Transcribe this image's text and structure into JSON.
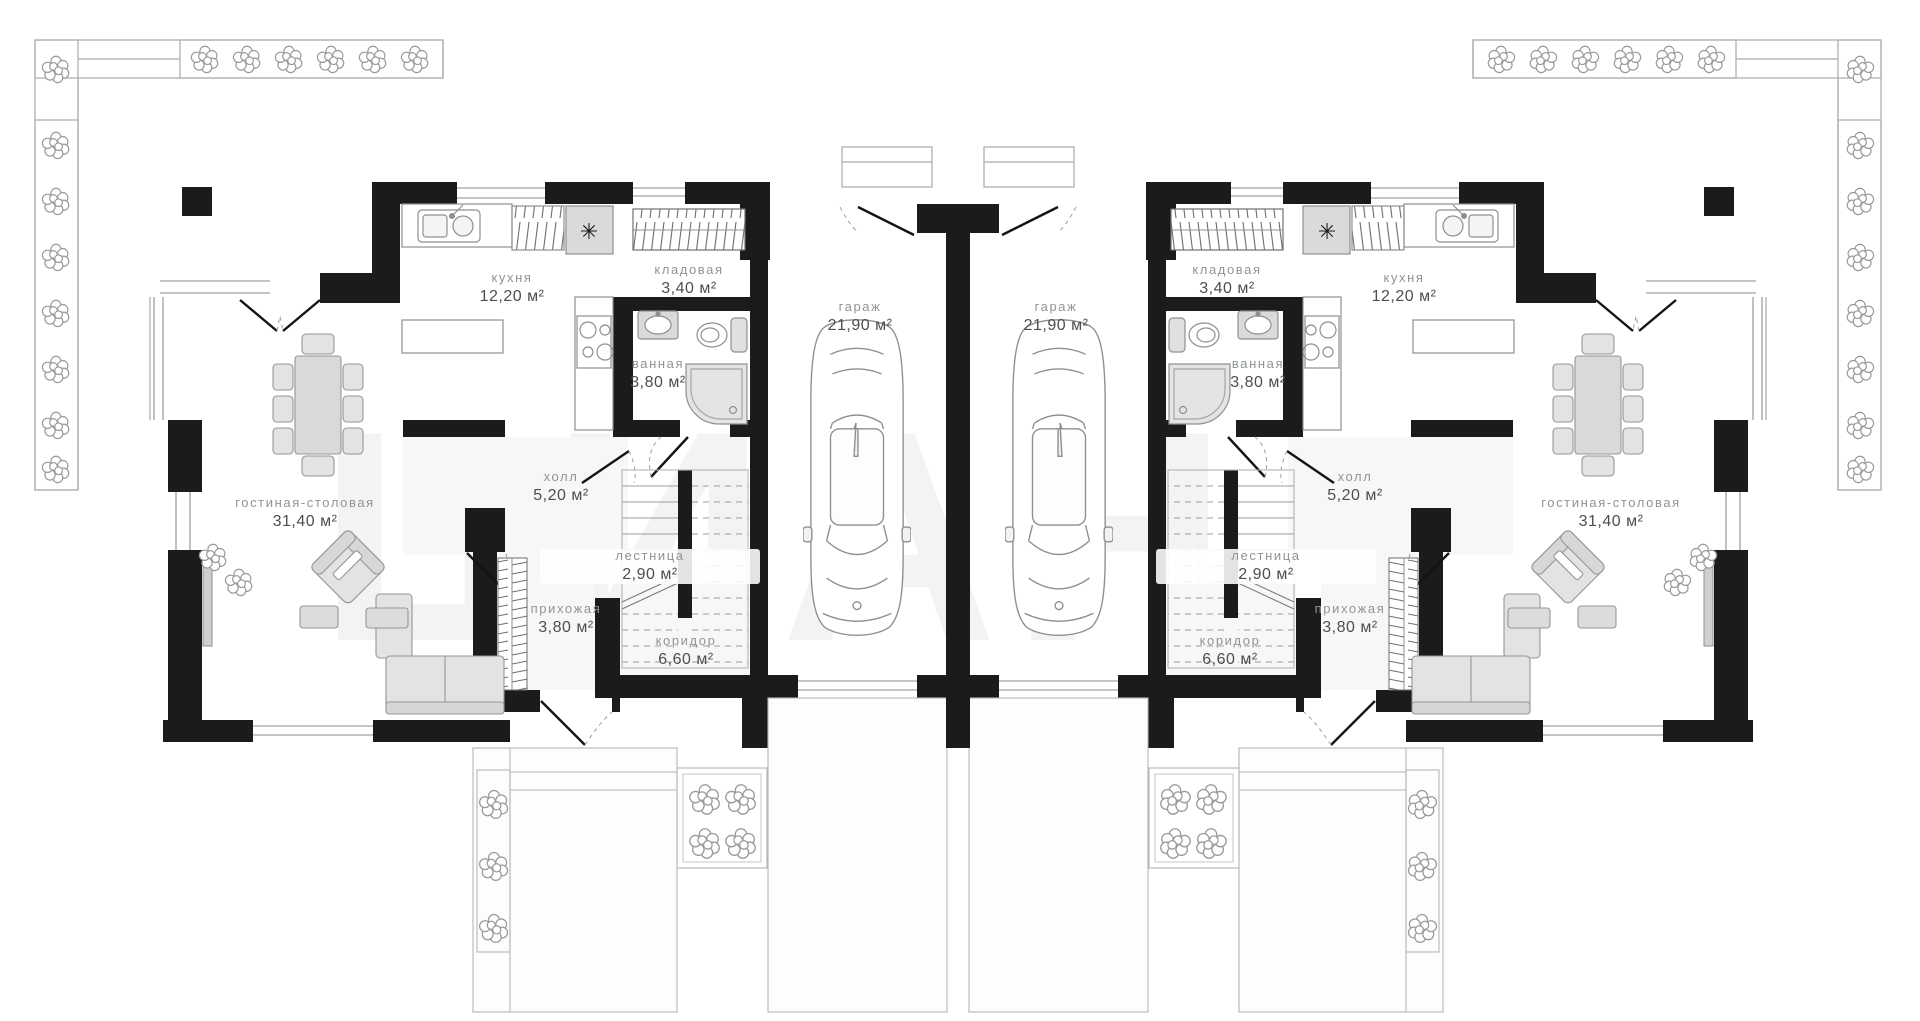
{
  "watermark": "ЦИАН",
  "icons": {
    "fridge": "✳"
  },
  "colors": {
    "wall": "#1b1b1b",
    "outline": "#a5a5a5",
    "furniture_stroke": "#8f8f8f",
    "furniture_fill": "#e4e4e4",
    "label_name": "#8f9497",
    "label_area": "#4a4f53"
  },
  "rooms": [
    {
      "unit": "left",
      "name": "кухня",
      "area": "12,20 м²"
    },
    {
      "unit": "left",
      "name": "кладовая",
      "area": "3,40 м²"
    },
    {
      "unit": "left",
      "name": "ванная",
      "area": "3,80 м²"
    },
    {
      "unit": "left",
      "name": "гараж",
      "area": "21,90 м²"
    },
    {
      "unit": "left",
      "name": "холл",
      "area": "5,20 м²"
    },
    {
      "unit": "left",
      "name": "лестница",
      "area": "2,90 м²"
    },
    {
      "unit": "left",
      "name": "прихожая",
      "area": "3,80 м²"
    },
    {
      "unit": "left",
      "name": "коридор",
      "area": "6,60 м²"
    },
    {
      "unit": "left",
      "name": "гостиная-столовая",
      "area": "31,40 м²"
    },
    {
      "unit": "right",
      "name": "гараж",
      "area": "21,90 м²"
    },
    {
      "unit": "right",
      "name": "кладовая",
      "area": "3,40 м²"
    },
    {
      "unit": "right",
      "name": "ванная",
      "area": "3,80 м²"
    },
    {
      "unit": "right",
      "name": "кухня",
      "area": "12,20 м²"
    },
    {
      "unit": "right",
      "name": "холл",
      "area": "5,20 м²"
    },
    {
      "unit": "right",
      "name": "лестница",
      "area": "2,90 м²"
    },
    {
      "unit": "right",
      "name": "прихожая",
      "area": "3,80 м²"
    },
    {
      "unit": "right",
      "name": "коридор",
      "area": "6,60 м²"
    },
    {
      "unit": "right",
      "name": "гостиная-столовая",
      "area": "31,40 м²"
    }
  ]
}
